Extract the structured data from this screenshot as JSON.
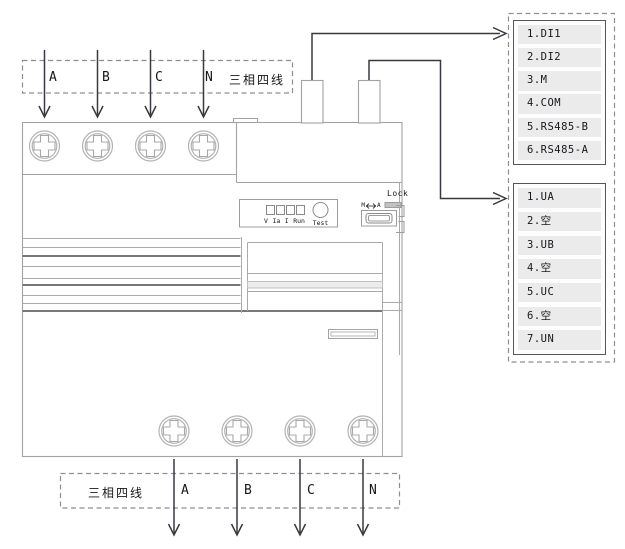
{
  "top_wiring": {
    "system_label": "三相四线",
    "phases": [
      "A",
      "B",
      "C",
      "N"
    ]
  },
  "bottom_wiring": {
    "system_label": "三相四线",
    "phases": [
      "A",
      "B",
      "C",
      "N"
    ]
  },
  "signal_terminal_block": {
    "rows": [
      "1.DI1",
      "2.DI2",
      "3.M",
      "4.COM",
      "5.RS485-B",
      "6.RS485-A"
    ]
  },
  "voltage_terminal_block": {
    "rows": [
      "1.UA",
      "2.空",
      "3.UB",
      "4.空",
      "5.UC",
      "6.空",
      "7.UN"
    ]
  },
  "device": {
    "led_labels": [
      "V",
      "Ia",
      "I",
      "Run"
    ],
    "test_label": "Test",
    "lock_label": "Lock",
    "mode_switch_left": "M",
    "mode_switch_right": "A"
  },
  "colors": {
    "line": "#a3a3a3",
    "dark_line": "#787878",
    "arrow": "#383840",
    "dashed": "#8e8e8e",
    "row_fill": "#ebebeb"
  }
}
